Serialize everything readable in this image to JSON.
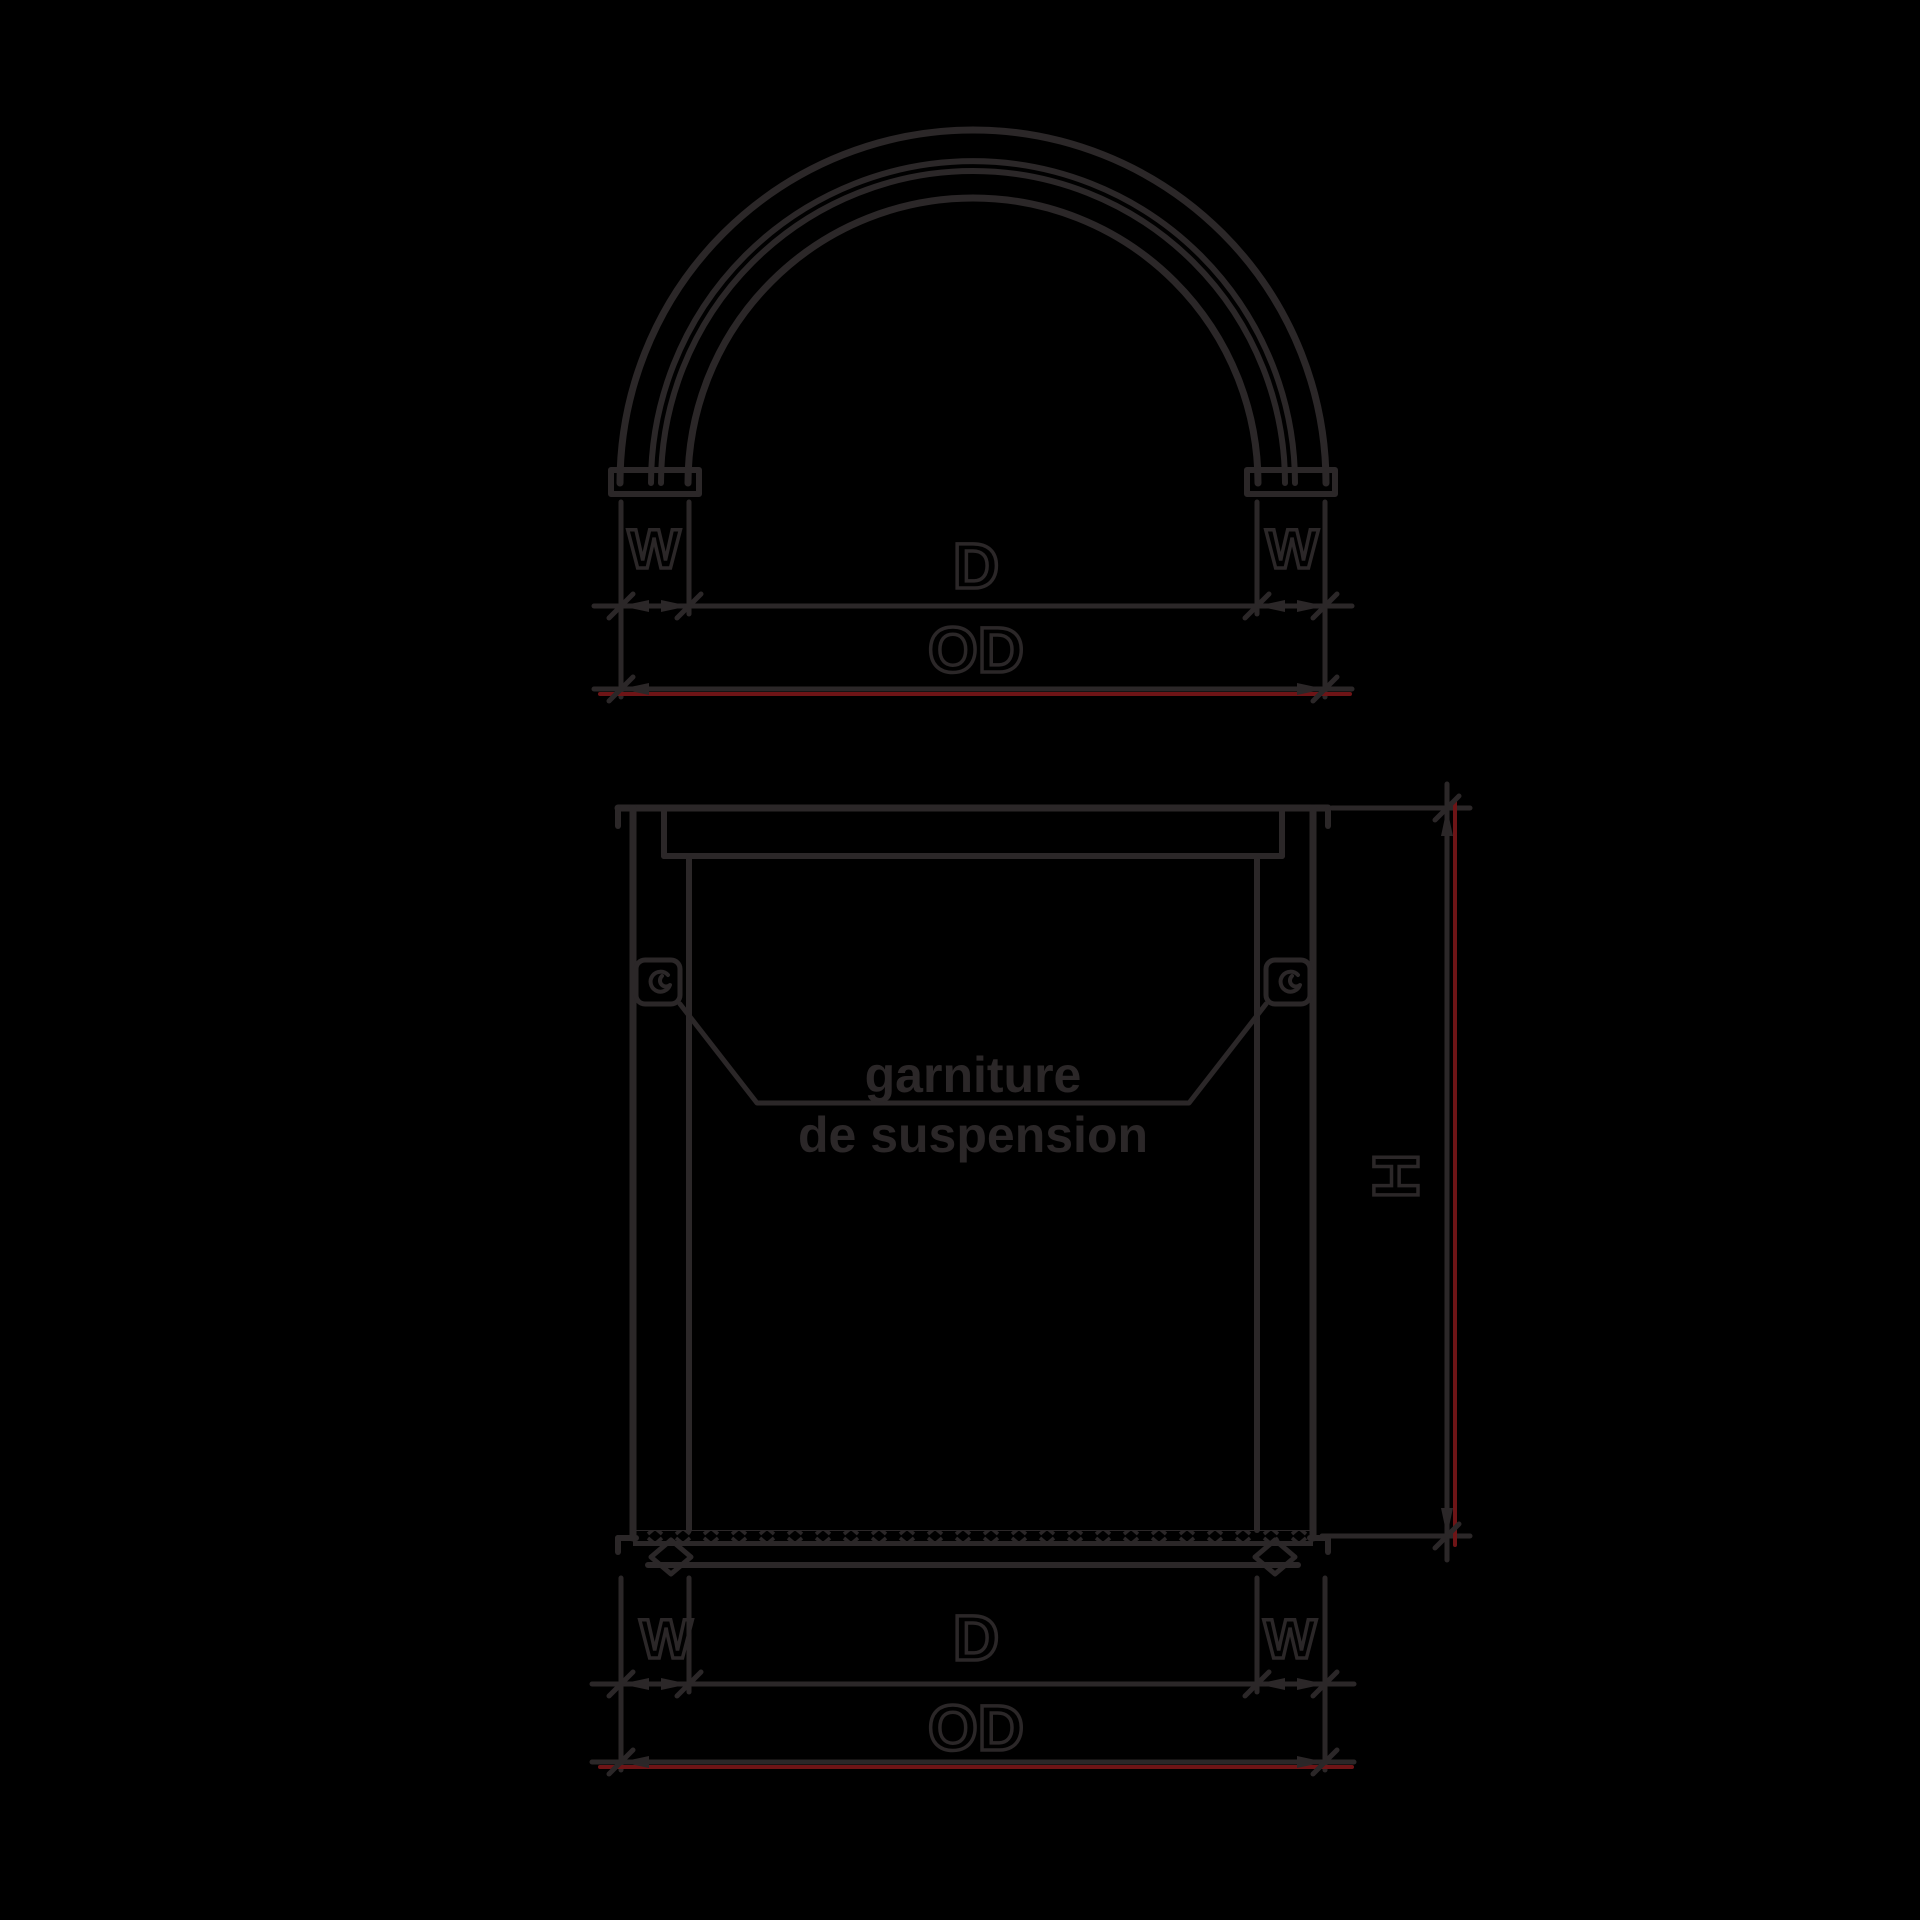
{
  "colors": {
    "background": "#000000",
    "ink": "#2b2728",
    "dimension_red": "#6e1416"
  },
  "top_view": {
    "label_w_left": "W",
    "label_d": "D",
    "label_w_right": "W",
    "label_od": "OD"
  },
  "front_view": {
    "label_w_left": "W",
    "label_d": "D",
    "label_w_right": "W",
    "label_od": "OD",
    "label_h": "H",
    "annotation_line1": "garniture",
    "annotation_line2": "de suspension"
  }
}
